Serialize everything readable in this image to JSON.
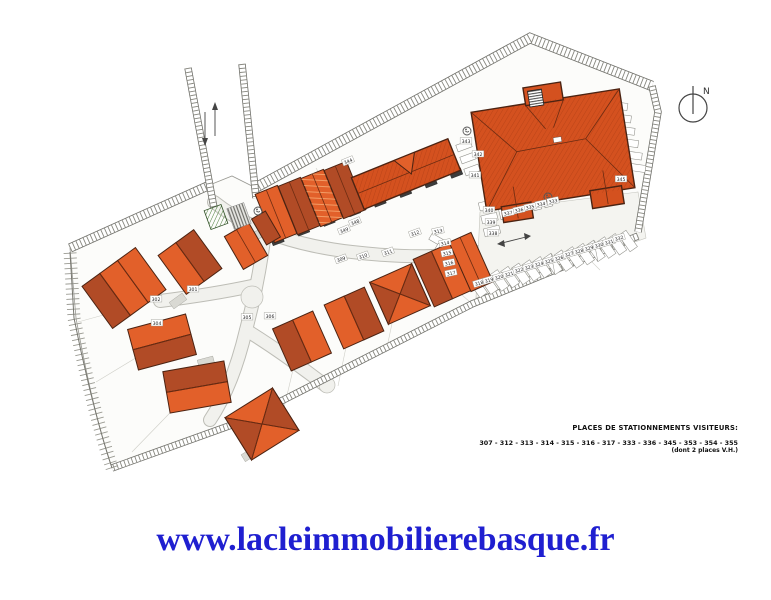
{
  "watermark": {
    "url_text": "www.lacleimmobilierebasque.fr",
    "color": "#1f1fd0"
  },
  "north": {
    "label": "N"
  },
  "notes": {
    "title": "PLACES DE STATIONNEMENTS VISITEURS:",
    "numbers": "307 - 312 - 313 - 314 - 315 - 316 - 317 - 333 - 336 - 345 - 353 - 354 - 355",
    "suffix": "(dont 2 places V.H.)"
  },
  "icons": {
    "north": "compass-circle",
    "accessible_parking": "wheelchair-circle",
    "lane_arrows": "two-way-arrows",
    "road_arrow": "two-way-arrow"
  },
  "plan": {
    "colors": {
      "roof_bright": "#e2602a",
      "roof_dark": "#b14b26",
      "roof_main": "#d4511f",
      "outline": "#4b2312",
      "road": "#f1f1ed",
      "ground": "#fcfcfa",
      "hatch_green": "#4a7d3a",
      "note_ink": "#111111",
      "url_blue": "#1f1fd0"
    },
    "labels": [
      {
        "t": "301",
        "x": 193,
        "y": 289,
        "r": 0
      },
      {
        "t": "302",
        "x": 156,
        "y": 299,
        "r": 0
      },
      {
        "t": "304",
        "x": 157,
        "y": 323,
        "r": 0
      },
      {
        "t": "305",
        "x": 247,
        "y": 317,
        "r": 0
      },
      {
        "t": "306",
        "x": 270,
        "y": 316,
        "r": 0
      },
      {
        "t": "309",
        "x": 341,
        "y": 259,
        "r": -20
      },
      {
        "t": "310",
        "x": 363,
        "y": 256,
        "r": -20
      },
      {
        "t": "311",
        "x": 388,
        "y": 252,
        "r": -20
      },
      {
        "t": "312",
        "x": 415,
        "y": 233,
        "r": -20
      },
      {
        "t": "313",
        "x": 438,
        "y": 231,
        "r": -12
      },
      {
        "t": "314",
        "x": 445,
        "y": 243,
        "r": -12
      },
      {
        "t": "315",
        "x": 447,
        "y": 253,
        "r": -12
      },
      {
        "t": "316",
        "x": 449,
        "y": 263,
        "r": -12
      },
      {
        "t": "317",
        "x": 451,
        "y": 273,
        "r": -12
      },
      {
        "t": "318",
        "x": 479,
        "y": 283,
        "r": -17
      },
      {
        "t": "319",
        "x": 489,
        "y": 280,
        "r": -17
      },
      {
        "t": "320",
        "x": 499,
        "y": 277,
        "r": -17
      },
      {
        "t": "321",
        "x": 509,
        "y": 274,
        "r": -17
      },
      {
        "t": "322",
        "x": 519,
        "y": 270,
        "r": -17
      },
      {
        "t": "323",
        "x": 529,
        "y": 267,
        "r": -17
      },
      {
        "t": "324",
        "x": 539,
        "y": 264,
        "r": -17
      },
      {
        "t": "325",
        "x": 549,
        "y": 261,
        "r": -17
      },
      {
        "t": "326",
        "x": 559,
        "y": 258,
        "r": -17
      },
      {
        "t": "327",
        "x": 569,
        "y": 254,
        "r": -17
      },
      {
        "t": "328",
        "x": 579,
        "y": 251,
        "r": -17
      },
      {
        "t": "329",
        "x": 589,
        "y": 248,
        "r": -17
      },
      {
        "t": "330",
        "x": 599,
        "y": 245,
        "r": -17
      },
      {
        "t": "331",
        "x": 609,
        "y": 242,
        "r": -17
      },
      {
        "t": "332",
        "x": 619,
        "y": 238,
        "r": -17
      },
      {
        "t": "333",
        "x": 553,
        "y": 201,
        "r": -12
      },
      {
        "t": "334",
        "x": 541,
        "y": 204,
        "r": -12
      },
      {
        "t": "335",
        "x": 530,
        "y": 207,
        "r": -12
      },
      {
        "t": "336",
        "x": 519,
        "y": 210,
        "r": -12
      },
      {
        "t": "337",
        "x": 508,
        "y": 213,
        "r": -12
      },
      {
        "t": "338",
        "x": 493,
        "y": 233,
        "r": 0
      },
      {
        "t": "339",
        "x": 491,
        "y": 222,
        "r": 0
      },
      {
        "t": "340",
        "x": 489,
        "y": 210,
        "r": 0
      },
      {
        "t": "341",
        "x": 475,
        "y": 175,
        "r": 0
      },
      {
        "t": "342",
        "x": 478,
        "y": 154,
        "r": 0
      },
      {
        "t": "343",
        "x": 466,
        "y": 141,
        "r": 0
      },
      {
        "t": "344",
        "x": 348,
        "y": 161,
        "r": -22
      },
      {
        "t": "345",
        "x": 621,
        "y": 179,
        "r": 0
      },
      {
        "t": "348",
        "x": 355,
        "y": 222,
        "r": -22
      },
      {
        "t": "349",
        "x": 344,
        "y": 230,
        "r": -22
      }
    ]
  }
}
